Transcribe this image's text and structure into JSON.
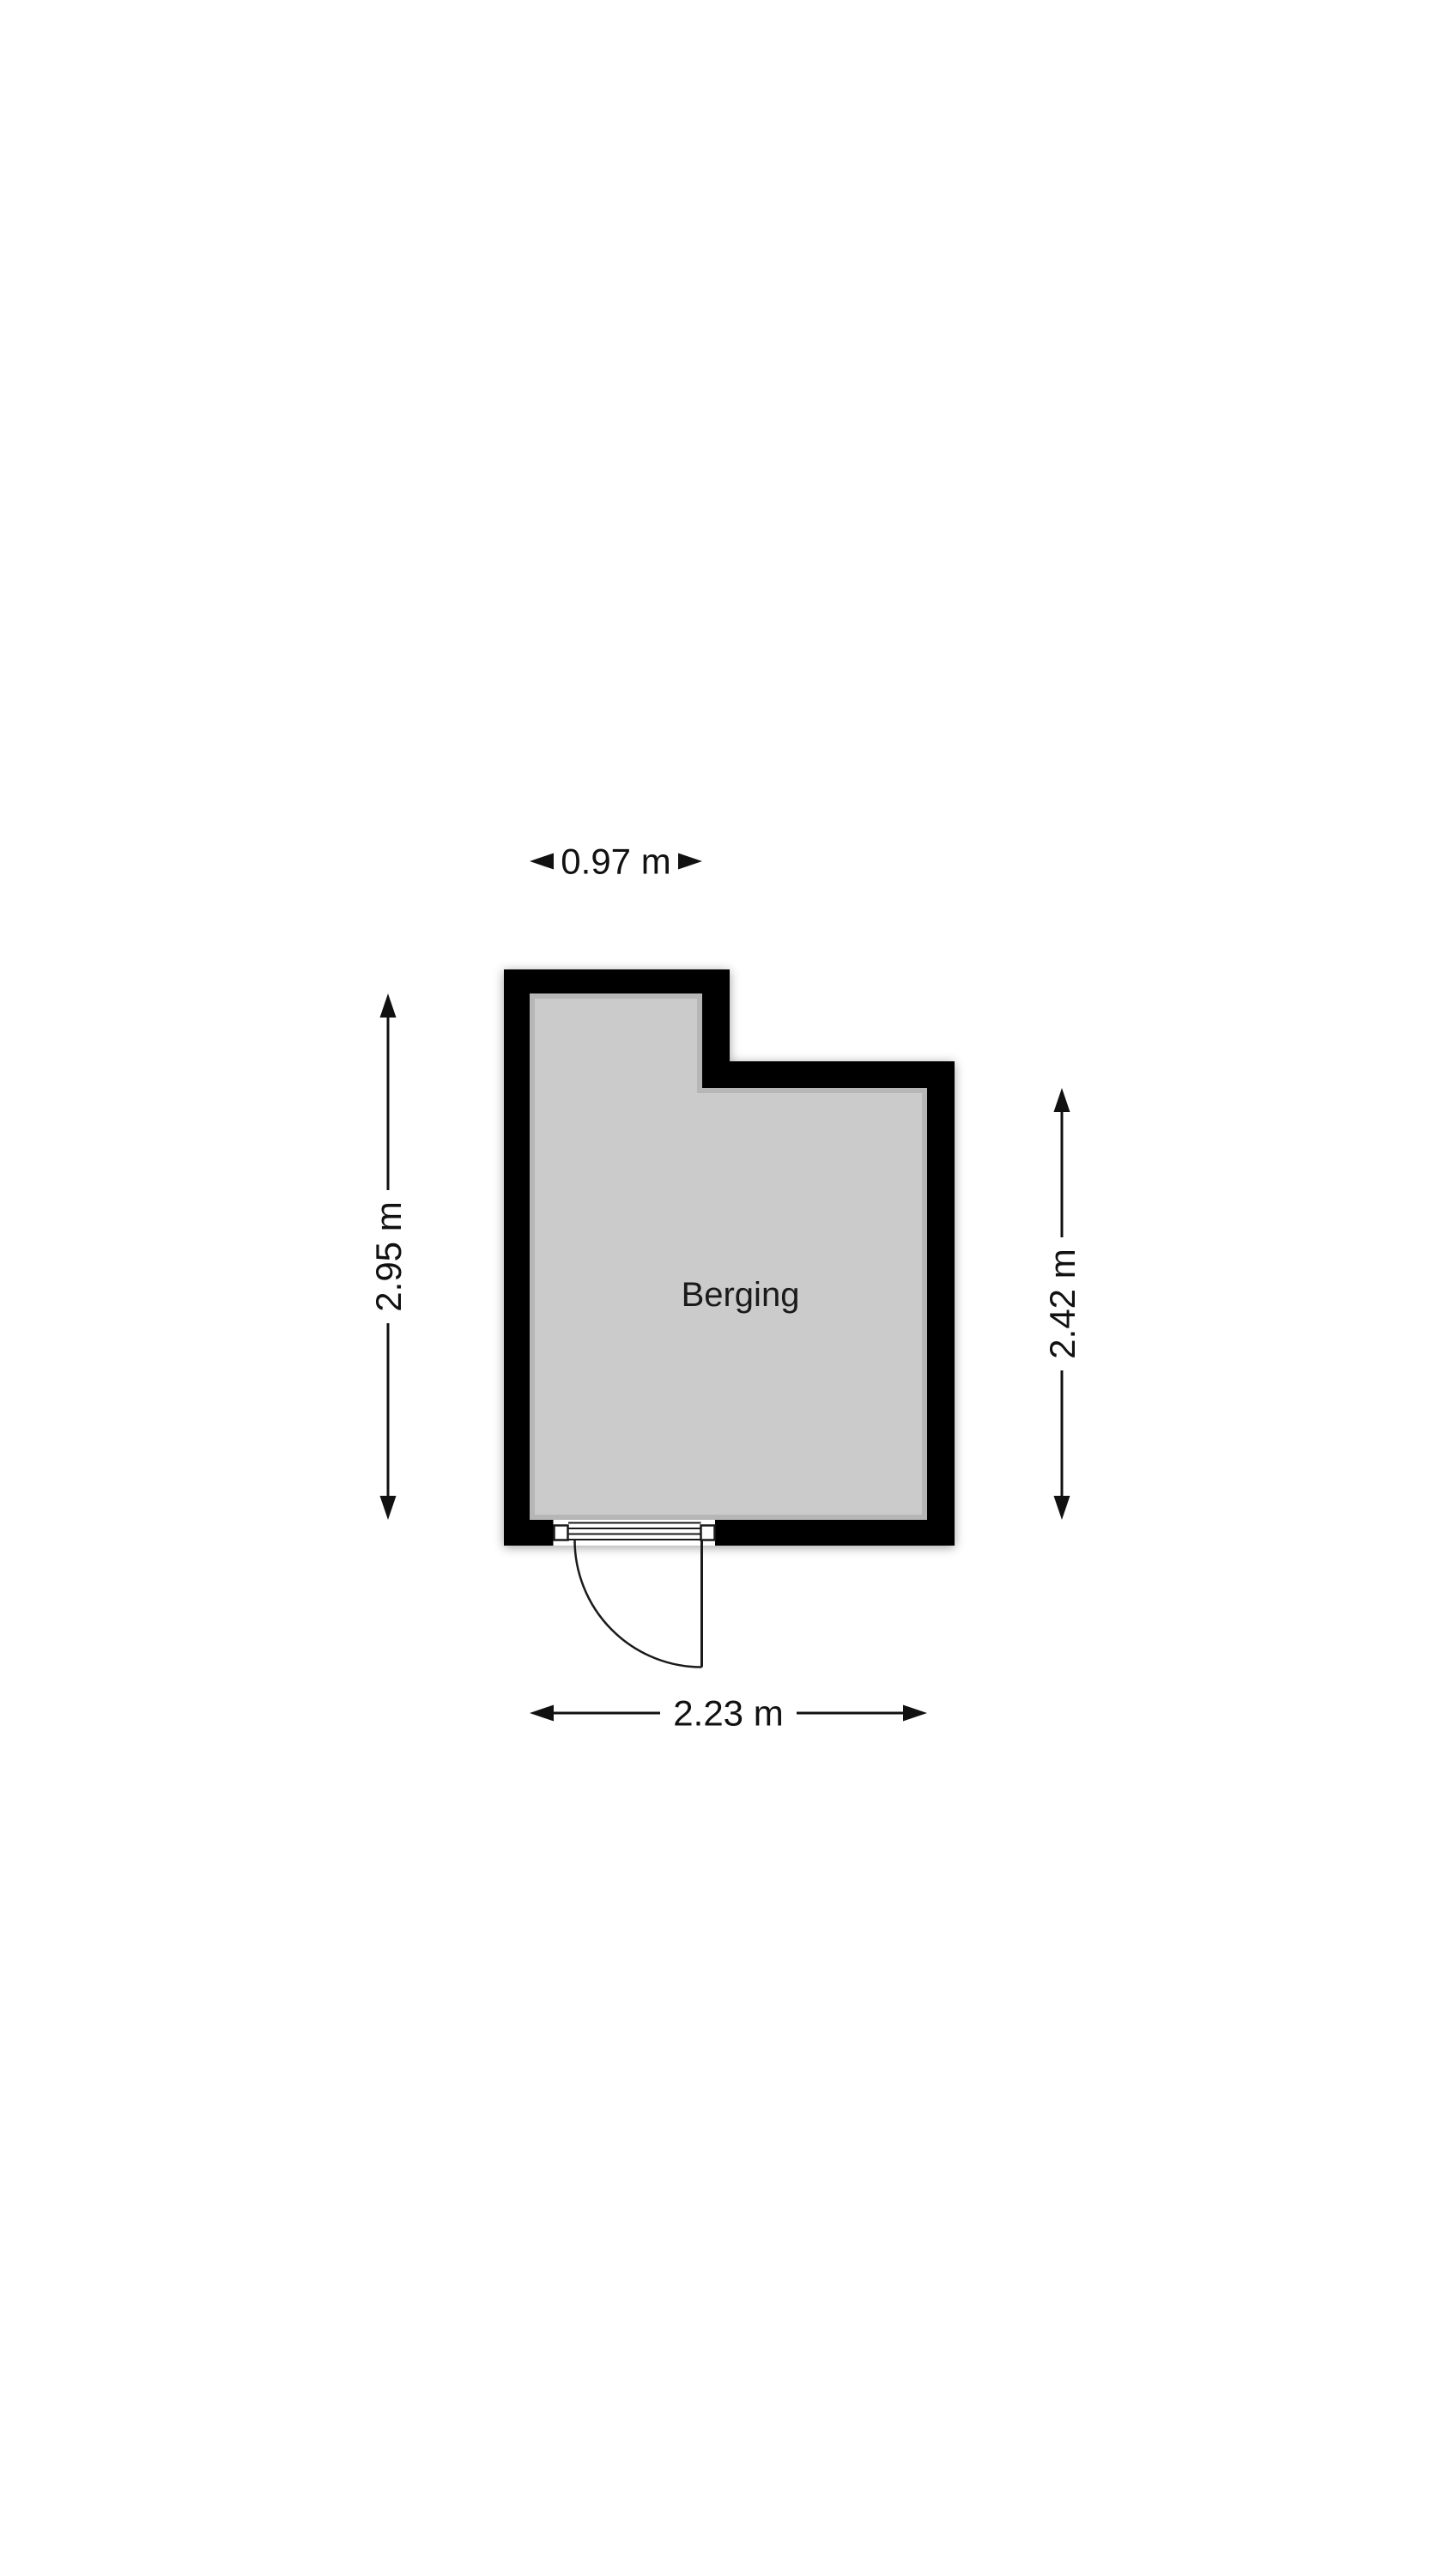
{
  "floorplan": {
    "room": {
      "label": "Berging"
    },
    "dimensions": {
      "top": {
        "label": "0.97 m"
      },
      "left": {
        "label": "2.95 m"
      },
      "right": {
        "label": "2.42 m"
      },
      "bottom": {
        "label": "2.23 m"
      }
    },
    "colors": {
      "wall": "#000000",
      "floor": "#cbcbcb",
      "text": "#111111",
      "background": "#ffffff"
    }
  }
}
